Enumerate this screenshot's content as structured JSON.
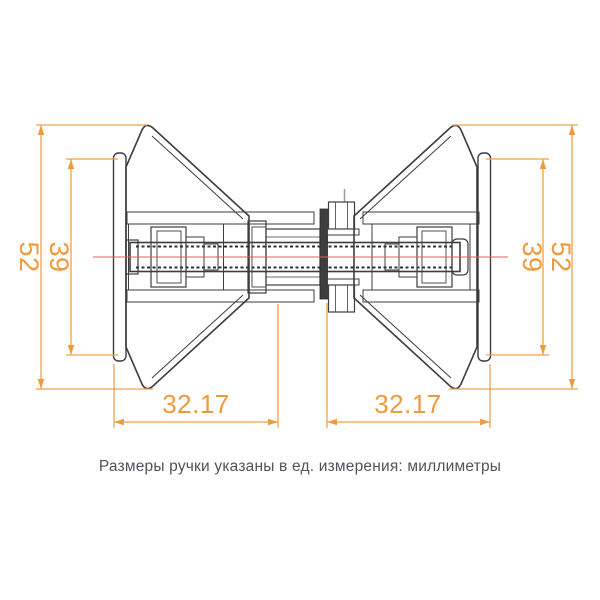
{
  "drawing": {
    "caption": "Размеры ручки указаны в ед. измерения: миллиметры",
    "dimension_labels": {
      "left_outer_height": "52",
      "left_plate_height": "39",
      "right_plate_height": "39",
      "right_outer_height": "52",
      "bottom_left_width": "32.17",
      "bottom_right_width": "32.17"
    },
    "colors": {
      "dimension_accent": "#F09A3E",
      "centerline_red": "#E05D5D",
      "drawing_outline": "#3D3D3D",
      "glass_panel_fill": "#3E3E3E",
      "background": "#FFFFFF"
    }
  }
}
